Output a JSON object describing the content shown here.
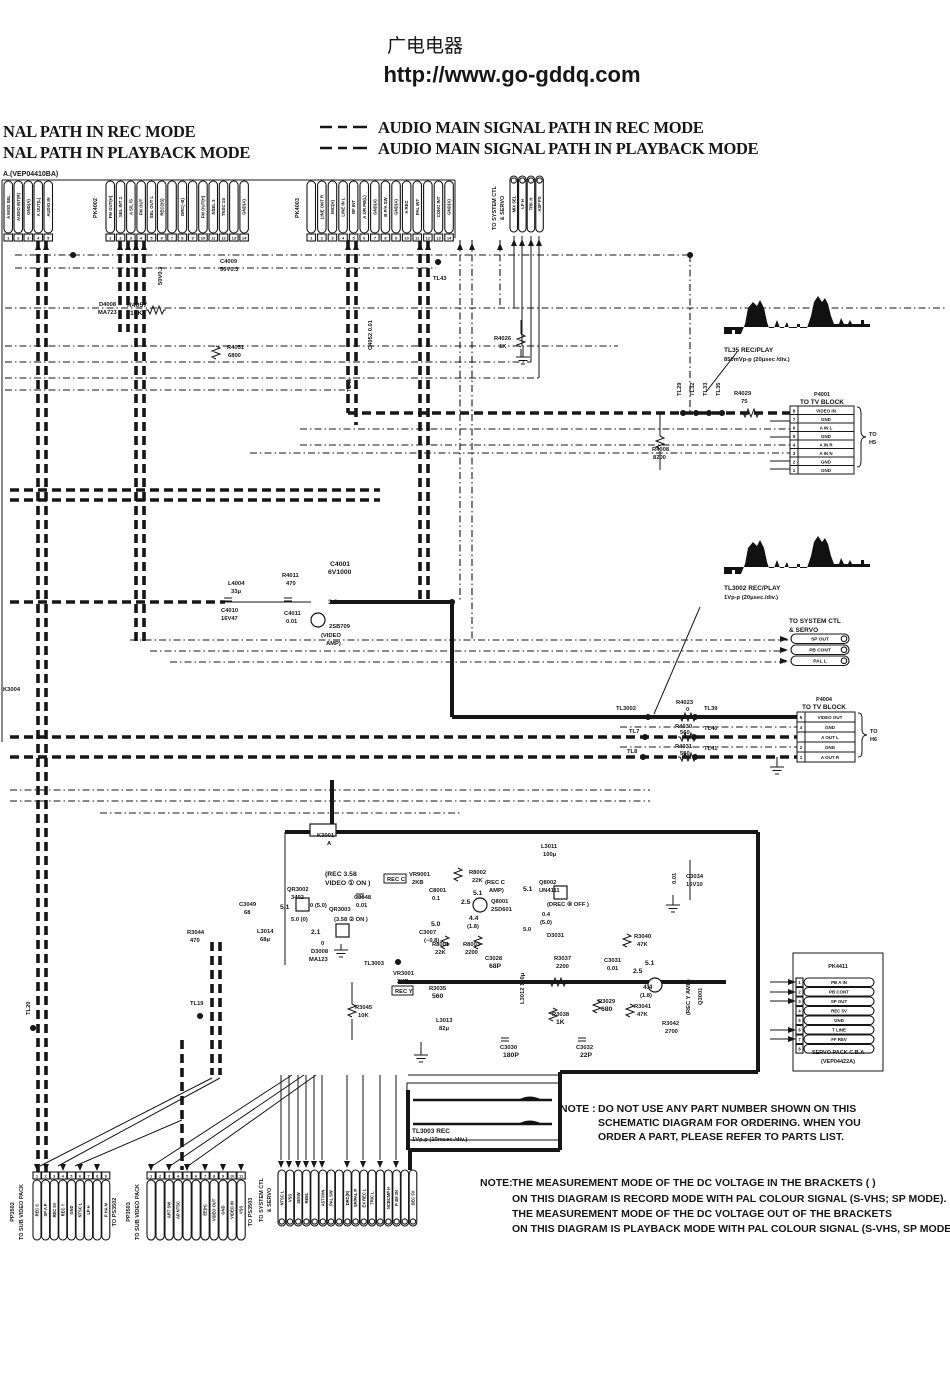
{
  "colors": {
    "ink": "#161616",
    "paper": "#ffffff"
  },
  "header": {
    "site_name": "广电电器",
    "site_url": "http://www.go-gddq.com"
  },
  "legend": {
    "row1_left": "NAL PATH IN REC MODE",
    "row2_left": "NAL PATH IN PLAYBACK MODE",
    "row1_right": "AUDIO MAIN SIGNAL PATH IN REC MODE",
    "row2_right": "AUDIO MAIN SIGNAL PATH IN PLAYBACK MODE"
  },
  "board": {
    "label": "A.(VEP04410BA)"
  },
  "top_connectors": {
    "cluster_a": {
      "pins": [
        "A MOD SEL",
        "AUDIO INT(R)",
        "GND(A)",
        "A OUT(L)",
        "AUDIO IN"
      ]
    },
    "pk4002": {
      "label": "PK4002",
      "pins": [
        "FM OUT(H)",
        "SEL INT 2",
        "A S/L /S",
        "FM OUT",
        "SEL OUT L",
        "REC(3S)",
        "",
        "DRC(~B)",
        "",
        "FM OUT(H)",
        "NSEL 3",
        "TNSC 1S",
        "",
        "GND(A)"
      ]
    },
    "pk4003": {
      "label": "PK4003",
      "pins": [
        "",
        "LINE ONT R",
        "MIC(H)",
        "LINE IN L",
        "RF INT",
        "A 3/R PB(L)",
        "GND(A)",
        "B P/A SW",
        "GND(A)",
        "A REC",
        "PAL INT",
        "",
        "CONC INT",
        "GND(A)"
      ]
    },
    "sysctl_top": {
      "title_l1": "TO SYSTEM CTL",
      "title_l2": "& SERVO",
      "pins": [
        "MIX SEL",
        "LP H",
        "TRK H",
        "ASP PS"
      ]
    }
  },
  "waveforms": {
    "tl35": {
      "label": "TL35 REC/PLAY",
      "scale": "850mVp-p (20μsec /div.)"
    },
    "tl3002": {
      "label": "TL3002 REC/PLAY",
      "scale": "1Vp-p (20μsec./div.)"
    },
    "tl3003": {
      "label": "TL3003 REC",
      "scale": "1Vp.p (10msec./div.)"
    }
  },
  "tv_block_1": {
    "ref": "P4001",
    "title": "TO TV BLOCK",
    "dest_l1": "TO",
    "dest_l2": "H5",
    "rows": [
      {
        "n": "8",
        "label": "VIDEO IN"
      },
      {
        "n": "7",
        "label": "GND"
      },
      {
        "n": "6",
        "label": "A IN L"
      },
      {
        "n": "5",
        "label": "GND"
      },
      {
        "n": "4",
        "label": "A IN R"
      },
      {
        "n": "3",
        "label": "A IN N"
      },
      {
        "n": "2",
        "label": "GND"
      },
      {
        "n": "1",
        "label": "GND"
      }
    ]
  },
  "tv_block_2": {
    "ref": "P4004",
    "title": "TO TV BLOCK",
    "dest_l1": "TO",
    "dest_l2": "H6",
    "rows": [
      {
        "n": "5",
        "label": "VIDEO OUT"
      },
      {
        "n": "4",
        "label": "GND"
      },
      {
        "n": "3",
        "label": "A OUT L"
      },
      {
        "n": "2",
        "label": "GND"
      },
      {
        "n": "1",
        "label": "A OUT R"
      }
    ]
  },
  "sysctl_mid": {
    "title_l1": "TO SYSTEM CTL",
    "title_l2": "& SERVO",
    "pins": [
      "SP OUT",
      "PB CONT",
      "PAL L"
    ]
  },
  "servo_pack": {
    "ref": "PK4411",
    "pins": [
      "PB A IN",
      "PB CONT",
      "SP OUT",
      "REC 5V",
      "GND",
      "T LINE",
      "FF REV",
      ""
    ],
    "footer_l1": "SERVO PACK C.B.A",
    "footer_l2": "(VEP04422A)"
  },
  "notes": {
    "note1_label": "NOTE :",
    "note1_lines": [
      "DO NOT USE ANY PART NUMBER SHOWN ON THIS",
      "SCHEMATIC DIAGRAM FOR ORDERING.  WHEN YOU",
      "ORDER A PART, PLEASE REFER TO PARTS LIST."
    ],
    "note2_label": "NOTE:",
    "note2_lines": [
      "THE MEASUREMENT MODE OF THE DC VOLTAGE IN THE BRACKETS (      )",
      "ON THIS DIAGRAM IS RECORD MODE WITH PAL COLOUR SIGNAL (S-VHS; SP MODE).",
      "THE MEASUREMENT MODE OF THE DC VOLTAGE OUT OF THE BRACKETS",
      "ON THIS DIAGRAM IS PLAYBACK MODE WITH PAL COLOUR SIGNAL (S-VHS, SP MODE)"
    ]
  },
  "bottom_connectors": {
    "pp3502": {
      "ref": "PP3502",
      "title": "TO SUB VIDEO PACK",
      "dest": "TO PS3502",
      "pins": [
        "REC C",
        "SP A P",
        "REC 5V",
        "REC Y",
        "GND",
        "NTSC L",
        "LP H",
        "",
        "P HA M"
      ]
    },
    "pp3503": {
      "ref": "PP3503",
      "title": "TO SUB VIDEO PACK",
      "dest": "TO PS3503",
      "pins": [
        "",
        "",
        "ART SW",
        "AP NTSC",
        "",
        "",
        "EE(H)",
        "VIDEO OUT",
        "GND",
        "VIDEO IN",
        "VSS"
      ]
    },
    "sysctl_bottom": {
      "title_l1": "TO SYSTEM CTL",
      "title_l2": "& SERVO",
      "pins": [
        "NTSC L",
        "VSS",
        "36SW",
        "REEL",
        "",
        "ASTVHN",
        "PAL SW",
        "",
        "DRC(R)",
        "SP/PAL P",
        "EX REC L",
        "TRIC L",
        "",
        "NCBCMP H",
        "P 4M 3N",
        "",
        "DEC 5V"
      ]
    }
  },
  "parts": [
    "C4009",
    "50V0.3",
    "50V0.3",
    "D4008",
    "MA723",
    "R4057",
    "10K",
    "R4051",
    "6800",
    "TL43",
    "R4026",
    "1K",
    "C4052 0.01",
    "TL45",
    "TL29",
    "TL32",
    "TL33",
    "TL35",
    "R4029",
    "75",
    "R4008",
    "8200",
    "L4004",
    "33μ",
    "R4011",
    "470",
    "C4001",
    "6V1000",
    "C4010",
    "16V47",
    "C4011",
    "0.01",
    "3.6",
    "2SB709",
    "(VIDEO",
    "AMP)",
    "TL3002",
    "R4023",
    "0",
    "TL39",
    "TL7",
    "R4030",
    "560",
    "TL40",
    "TL8",
    "R4031",
    "560",
    "TL41",
    "K3001",
    "A",
    "L3011",
    "100μ",
    "(REC 3.58",
    "VIDEO ① ON )",
    "QR3002",
    "3402",
    "5.1",
    "0 (5.0)",
    "5.0 (0)",
    "C3048",
    "0.01",
    "QR3003",
    "(3.58 ② ON )",
    "2.1",
    "0",
    "REC C",
    "VR9001",
    "2KB",
    "C8001",
    "0.1",
    "R8002",
    "22K",
    "(REC  C",
    "AMP)",
    "5.1",
    "2.5",
    "Q8001",
    "2SD601",
    "4.4",
    "(1.8)",
    "R8001",
    "22K",
    "R8003",
    "2200",
    "C3007",
    "5.0",
    "(−0.8)",
    "Q8002",
    "UN4111",
    "(DREC ⑧ OFF )",
    "5.1",
    "0.4",
    "(5.0)",
    "D3031",
    "5.0",
    "C3034",
    "16V10",
    "0.01",
    "R3040",
    "47K",
    "R3044",
    "470",
    "C3049",
    "68",
    "L3014",
    "68μ",
    "D3008",
    "MA123",
    "TL3003",
    "VR3001",
    "2KB",
    "REC Y",
    "R3035",
    "560",
    "L3013",
    "82μ",
    "L3012 150μ",
    "C3028",
    "68P",
    "R3037",
    "2200",
    "C3031",
    "0.01",
    "R3038",
    "1K",
    "R3029",
    "680",
    "C3030",
    "180P",
    "C3032",
    "22P",
    "R3041",
    "47K",
    "R3042",
    "2700",
    "2.5",
    "5.1",
    "4.4",
    "(1.8)",
    "Q3001",
    "(REC Y AMP)",
    "R3045",
    "10K",
    "TL19",
    "TL20",
    "K3004"
  ]
}
